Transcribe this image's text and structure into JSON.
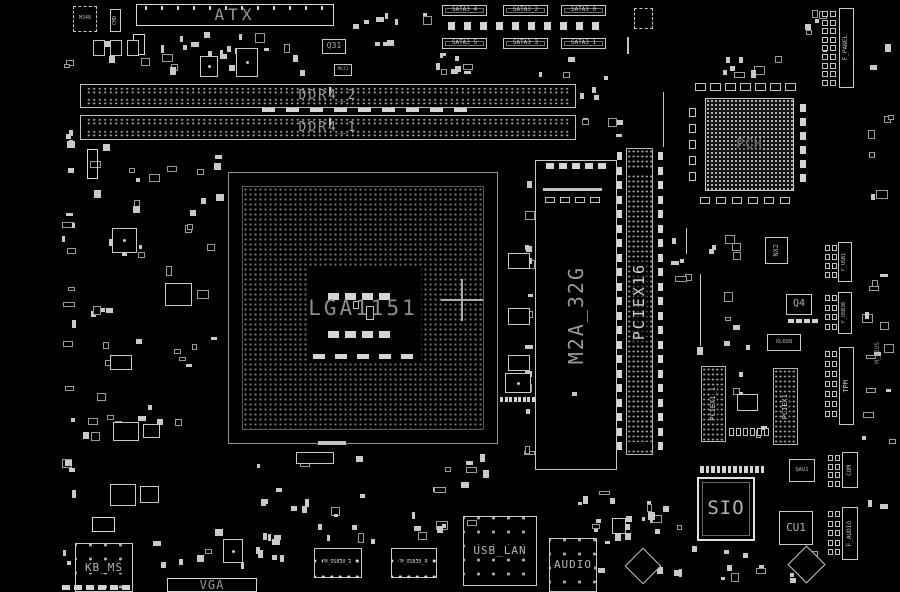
{
  "board": {
    "width": 900,
    "height": 592,
    "background": "#000000",
    "silkscreen": "#d0d0d0",
    "label_color": "#9a9a9a"
  },
  "parts": [
    {
      "t": "conn",
      "id": "atx-connector",
      "lab": "ATX",
      "x": 136,
      "y": 4,
      "w": 198,
      "h": 22,
      "fs": 16,
      "ls": 4,
      "ticks": true
    },
    {
      "t": "chip",
      "id": "chip-m348",
      "lab": "M348",
      "x": 73,
      "y": 6,
      "w": 24,
      "h": 26,
      "fs": 5,
      "dash": true
    },
    {
      "t": "vconn",
      "id": "conn-cmd",
      "lab": "CMD",
      "x": 110,
      "y": 9,
      "w": 11,
      "h": 23,
      "fs": 5
    },
    {
      "t": "conn",
      "id": "conn-small-1",
      "lab": "",
      "x": 133,
      "y": 34,
      "w": 12,
      "h": 21,
      "fs": 5
    },
    {
      "t": "chip",
      "id": "chip-q31",
      "lab": "Q31",
      "x": 322,
      "y": 39,
      "w": 24,
      "h": 15,
      "fs": 8
    },
    {
      "t": "chip",
      "id": "chip-mg71",
      "lab": "MG71",
      "x": 334,
      "y": 64,
      "w": 18,
      "h": 12,
      "fs": 4.5
    },
    {
      "t": "qfn",
      "id": "chip-u1",
      "x": 200,
      "y": 56,
      "w": 18,
      "h": 21
    },
    {
      "t": "qfn",
      "id": "chip-u2",
      "x": 236,
      "y": 48,
      "w": 22,
      "h": 29
    },
    {
      "t": "pads",
      "id": "cap-row",
      "x": 93,
      "y": 40,
      "cols": 3,
      "rows": 1,
      "dx": 17,
      "dy": 0,
      "pw": 12,
      "ph": 16,
      "hollow": true
    },
    {
      "t": "sconn",
      "id": "conn-sata3-4",
      "lab": "SATA3_4",
      "x": 442,
      "y": 5,
      "w": 45,
      "h": 11,
      "fs": 6
    },
    {
      "t": "sconn",
      "id": "conn-sata3-2",
      "lab": "SATA3_2",
      "x": 503,
      "y": 5,
      "w": 45,
      "h": 11,
      "fs": 6
    },
    {
      "t": "sconn",
      "id": "conn-sata3-0",
      "lab": "SATA3_0",
      "x": 561,
      "y": 5,
      "w": 45,
      "h": 11,
      "fs": 6
    },
    {
      "t": "sconn",
      "id": "conn-sata3-5",
      "lab": "SATA3_5",
      "x": 442,
      "y": 38,
      "w": 45,
      "h": 11,
      "fs": 6
    },
    {
      "t": "sconn",
      "id": "conn-sata3-3",
      "lab": "SATA3_3",
      "x": 503,
      "y": 38,
      "w": 45,
      "h": 11,
      "fs": 6
    },
    {
      "t": "sconn",
      "id": "conn-sata3-1",
      "lab": "SATA3_1",
      "x": 561,
      "y": 38,
      "w": 45,
      "h": 11,
      "fs": 6
    },
    {
      "t": "pads",
      "id": "sata-pad-row",
      "x": 448,
      "y": 22,
      "cols": 10,
      "rows": 1,
      "dx": 16,
      "dy": 0,
      "pw": 7,
      "ph": 8
    },
    {
      "t": "chip",
      "id": "chip-u8",
      "lab": "",
      "x": 634,
      "y": 8,
      "w": 19,
      "h": 21,
      "dash": true
    },
    {
      "t": "ln",
      "id": "silk-line-1",
      "x": 627,
      "y": 37,
      "w": 2,
      "h": 17
    },
    {
      "t": "dimm",
      "id": "slot-ddr4-2",
      "lab": "DDR4_2",
      "x": 80,
      "y": 84,
      "w": 496,
      "h": 24,
      "fs": 13
    },
    {
      "t": "dimm",
      "id": "slot-ddr4-1",
      "lab": "DDR4_1",
      "x": 80,
      "y": 115,
      "w": 496,
      "h": 25,
      "fs": 13
    },
    {
      "t": "pads",
      "id": "dimm-mid-pads",
      "x": 262,
      "y": 108,
      "cols": 9,
      "rows": 1,
      "dx": 24,
      "dy": 0,
      "pw": 13,
      "ph": 4
    },
    {
      "t": "cpu",
      "id": "socket-lga1151",
      "lab": "LGA1151",
      "x": 228,
      "y": 172,
      "w": 270,
      "h": 272,
      "fs": 21,
      "ko": [
        78,
        94,
        114,
        94
      ]
    },
    {
      "t": "cross",
      "id": "fiducial-cross",
      "x": 462,
      "y": 300,
      "s": 21
    },
    {
      "t": "m2",
      "id": "slot-m2a-32g",
      "lab": "M2A_32G",
      "x": 535,
      "y": 160,
      "w": 82,
      "h": 310,
      "fs": 20
    },
    {
      "t": "ln",
      "id": "m2-connector-bar",
      "x": 543,
      "y": 188,
      "w": 59,
      "h": 3
    },
    {
      "t": "pads",
      "id": "m2-pads-1",
      "x": 545,
      "y": 197,
      "cols": 4,
      "rows": 1,
      "dx": 15,
      "dy": 0,
      "pw": 10,
      "ph": 6,
      "hollow": true
    },
    {
      "t": "pads",
      "id": "m2-pads-2",
      "x": 546,
      "y": 163,
      "cols": 5,
      "rows": 1,
      "dx": 13,
      "dy": 0,
      "pw": 8,
      "ph": 6
    },
    {
      "t": "ln",
      "id": "m2-screw-pad",
      "x": 572,
      "y": 392,
      "w": 5,
      "h": 4
    },
    {
      "t": "px16",
      "id": "slot-pciex16",
      "lab": "PCIEX16",
      "x": 626,
      "y": 148,
      "w": 27,
      "h": 307,
      "fs": 15,
      "gaps": [
        20,
        293
      ]
    },
    {
      "t": "pads",
      "id": "px16-pads-left",
      "x": 617,
      "y": 152,
      "cols": 1,
      "rows": 21,
      "dx": 0,
      "dy": 14.5,
      "pw": 5,
      "ph": 8
    },
    {
      "t": "pads",
      "id": "px16-pads-right",
      "x": 658,
      "y": 152,
      "cols": 1,
      "rows": 21,
      "dx": 0,
      "dy": 14.5,
      "pw": 5,
      "ph": 8
    },
    {
      "t": "bga",
      "id": "chip-pch",
      "lab": "PCH",
      "x": 705,
      "y": 98,
      "w": 89,
      "h": 93,
      "fs": 13
    },
    {
      "t": "pads",
      "id": "pch-pads-top",
      "x": 695,
      "y": 83,
      "cols": 7,
      "rows": 1,
      "dx": 15,
      "dy": 0,
      "pw": 11,
      "ph": 8,
      "hollow": true
    },
    {
      "t": "pads",
      "id": "pch-pads-bottom",
      "x": 700,
      "y": 197,
      "cols": 6,
      "rows": 1,
      "dx": 16,
      "dy": 0,
      "pw": 10,
      "ph": 7,
      "hollow": true
    },
    {
      "t": "pads",
      "id": "pch-pads-left",
      "x": 689,
      "y": 108,
      "cols": 1,
      "rows": 5,
      "dx": 0,
      "dy": 16,
      "pw": 7,
      "ph": 9,
      "hollow": true
    },
    {
      "t": "pads",
      "id": "pch-pads-right",
      "x": 800,
      "y": 104,
      "cols": 1,
      "rows": 6,
      "dx": 0,
      "dy": 14,
      "pw": 6,
      "ph": 8
    },
    {
      "t": "vconn",
      "id": "conn-f-panel",
      "lab": "F_PANEL",
      "x": 839,
      "y": 8,
      "w": 15,
      "h": 80,
      "fs": 6
    },
    {
      "t": "pads",
      "id": "f-panel-pins",
      "x": 822,
      "y": 11,
      "cols": 2,
      "rows": 9,
      "dx": 8,
      "dy": 8.6,
      "pw": 6,
      "ph": 6,
      "hollow": true
    },
    {
      "t": "vconn",
      "id": "conn-f-usb1",
      "lab": "F_USB1",
      "x": 838,
      "y": 242,
      "w": 14,
      "h": 40,
      "fs": 5
    },
    {
      "t": "pads",
      "id": "f-usb1-pins",
      "x": 825,
      "y": 245,
      "cols": 2,
      "rows": 4,
      "dx": 7,
      "dy": 9,
      "pw": 5,
      "ph": 6,
      "hollow": true
    },
    {
      "t": "vconn",
      "id": "conn-f-usb30",
      "lab": "F_USB30",
      "x": 838,
      "y": 292,
      "w": 14,
      "h": 42,
      "fs": 5
    },
    {
      "t": "pads",
      "id": "f-usb30-pins",
      "x": 825,
      "y": 295,
      "cols": 2,
      "rows": 4,
      "dx": 7,
      "dy": 9.5,
      "pw": 5,
      "ph": 6,
      "hollow": true
    },
    {
      "t": "vconn",
      "id": "conn-tpm",
      "lab": "TPM",
      "x": 839,
      "y": 347,
      "w": 15,
      "h": 78,
      "fs": 7
    },
    {
      "t": "pads",
      "id": "tpm-pins",
      "x": 825,
      "y": 351,
      "cols": 2,
      "rows": 7,
      "dx": 7,
      "dy": 10,
      "pw": 5,
      "ph": 6,
      "hollow": true
    },
    {
      "t": "vconn",
      "id": "conn-com",
      "lab": "COM",
      "x": 842,
      "y": 452,
      "w": 16,
      "h": 36,
      "fs": 6
    },
    {
      "t": "pads",
      "id": "com-pins",
      "x": 828,
      "y": 455,
      "cols": 2,
      "rows": 4,
      "dx": 7,
      "dy": 8.5,
      "pw": 5,
      "ph": 6,
      "hollow": true
    },
    {
      "t": "vconn",
      "id": "conn-f-audio",
      "lab": "F_AUDIO",
      "x": 842,
      "y": 507,
      "w": 16,
      "h": 53,
      "fs": 6
    },
    {
      "t": "pads",
      "id": "f-audio-pins",
      "x": 828,
      "y": 511,
      "cols": 2,
      "rows": 5,
      "dx": 7,
      "dy": 9.5,
      "pw": 5,
      "ph": 6,
      "hollow": true
    },
    {
      "t": "vlabel",
      "id": "label-m-bios",
      "lab": "M_BIOS",
      "x": 872,
      "y": 330,
      "w": 12,
      "h": 46,
      "fs": 6
    },
    {
      "t": "vslot",
      "id": "slot-pciex1-1",
      "lab": "PCIEX1_1",
      "x": 701,
      "y": 366,
      "w": 25,
      "h": 76,
      "fs": 7
    },
    {
      "t": "vslot",
      "id": "slot-pciex1",
      "lab": "PCIEX1",
      "x": 773,
      "y": 368,
      "w": 25,
      "h": 77,
      "fs": 7
    },
    {
      "t": "chip",
      "id": "chip-nx2",
      "lab": "NX2",
      "x": 765,
      "y": 237,
      "w": 23,
      "h": 27,
      "fs": 7,
      "vlab": true
    },
    {
      "t": "chip",
      "id": "chip-q4",
      "lab": "Q4",
      "x": 786,
      "y": 294,
      "w": 26,
      "h": 21,
      "fs": 10
    },
    {
      "t": "pads",
      "id": "q4-pads",
      "x": 788,
      "y": 319,
      "cols": 4,
      "rows": 1,
      "dx": 8,
      "dy": 0,
      "pw": 6,
      "ph": 4
    },
    {
      "t": "chip",
      "id": "chip-bios",
      "lab": "XL608",
      "x": 767,
      "y": 334,
      "w": 34,
      "h": 17,
      "fs": 5.5
    },
    {
      "t": "chip",
      "id": "chip-u9",
      "lab": "",
      "x": 737,
      "y": 394,
      "w": 21,
      "h": 17
    },
    {
      "t": "pads",
      "id": "hdr-pads-mid",
      "x": 729,
      "y": 428,
      "cols": 6,
      "rows": 1,
      "dx": 7,
      "dy": 0,
      "pw": 5,
      "ph": 8,
      "hollow": true
    },
    {
      "t": "chip2",
      "id": "chip-sio",
      "lab": "SIO",
      "x": 697,
      "y": 477,
      "w": 58,
      "h": 64,
      "fs": 19
    },
    {
      "t": "pads",
      "id": "sio-pads-top",
      "x": 700,
      "y": 466,
      "cols": 12,
      "rows": 1,
      "dx": 5.5,
      "dy": 0,
      "pw": 3.5,
      "ph": 7
    },
    {
      "t": "chip",
      "id": "chip-qau1",
      "lab": "QAU1",
      "x": 789,
      "y": 459,
      "w": 26,
      "h": 23,
      "fs": 5.5
    },
    {
      "t": "chip",
      "id": "chip-cu1",
      "lab": "CU1",
      "x": 779,
      "y": 511,
      "w": 34,
      "h": 34,
      "fs": 11
    },
    {
      "t": "diam",
      "id": "chip-diamond-1",
      "x": 630,
      "y": 553,
      "s": 26
    },
    {
      "t": "diam",
      "id": "chip-diamond-2",
      "x": 793,
      "y": 551,
      "s": 27
    },
    {
      "t": "bigconn",
      "id": "conn-kb-ms",
      "lab": "KB_MS",
      "x": 75,
      "y": 543,
      "w": 58,
      "h": 49,
      "fs": 11
    },
    {
      "t": "conn",
      "id": "conn-vga",
      "lab": "VGA",
      "x": 167,
      "y": 578,
      "w": 90,
      "h": 14,
      "fs": 12,
      "ls": 1
    },
    {
      "t": "bigconn",
      "id": "conn-usb-lan",
      "lab": "USB_LAN",
      "x": 463,
      "y": 516,
      "w": 74,
      "h": 70,
      "fs": 11
    },
    {
      "t": "bigconn",
      "id": "conn-audio",
      "lab": "AUDIO",
      "x": 549,
      "y": 538,
      "w": 48,
      "h": 54,
      "fs": 11
    },
    {
      "t": "hdr",
      "id": "header-m-usb30-2",
      "lab": "M_USB30_2",
      "x": 314,
      "y": 548,
      "w": 48,
      "h": 30,
      "fs": 5
    },
    {
      "t": "hdr",
      "id": "header-m-usb30-4",
      "lab": "M_USB30_4",
      "x": 391,
      "y": 548,
      "w": 46,
      "h": 30,
      "fs": 5
    },
    {
      "t": "qfn",
      "id": "chip-vga-ctrl",
      "x": 223,
      "y": 539,
      "w": 20,
      "h": 24
    },
    {
      "t": "chip",
      "id": "chip-u10",
      "lab": "",
      "x": 612,
      "y": 518,
      "w": 14,
      "h": 16
    },
    {
      "t": "ln",
      "id": "silk-bar-1",
      "x": 318,
      "y": 441,
      "w": 28,
      "h": 4
    },
    {
      "t": "chip",
      "id": "chip-u11",
      "lab": "",
      "x": 296,
      "y": 452,
      "w": 38,
      "h": 12
    },
    {
      "t": "qfn",
      "id": "chip-u12",
      "x": 112,
      "y": 228,
      "w": 25,
      "h": 25
    },
    {
      "t": "chip",
      "id": "chip-u13",
      "lab": "",
      "x": 165,
      "y": 283,
      "w": 27,
      "h": 23
    },
    {
      "t": "chip",
      "id": "chip-u14",
      "lab": "",
      "x": 110,
      "y": 355,
      "w": 22,
      "h": 15
    },
    {
      "t": "chip",
      "id": "chip-u15",
      "lab": "",
      "x": 113,
      "y": 422,
      "w": 26,
      "h": 19
    },
    {
      "t": "chip",
      "id": "chip-u16",
      "lab": "",
      "x": 143,
      "y": 424,
      "w": 17,
      "h": 14
    },
    {
      "t": "chip",
      "id": "chip-u17",
      "lab": "",
      "x": 110,
      "y": 484,
      "w": 26,
      "h": 22
    },
    {
      "t": "chip",
      "id": "chip-u18",
      "lab": "",
      "x": 140,
      "y": 486,
      "w": 19,
      "h": 17
    },
    {
      "t": "conn",
      "id": "conn-small-2",
      "lab": "",
      "x": 87,
      "y": 149,
      "w": 11,
      "h": 30
    },
    {
      "t": "chip",
      "id": "chip-u19",
      "lab": "",
      "x": 508,
      "y": 253,
      "w": 22,
      "h": 16
    },
    {
      "t": "chip",
      "id": "chip-u20",
      "lab": "",
      "x": 508,
      "y": 308,
      "w": 22,
      "h": 17
    },
    {
      "t": "chip",
      "id": "chip-u21",
      "lab": "",
      "x": 508,
      "y": 355,
      "w": 22,
      "h": 16
    },
    {
      "t": "qfn",
      "id": "chip-u22",
      "x": 505,
      "y": 373,
      "w": 26,
      "h": 20
    },
    {
      "t": "pads",
      "id": "u22-pads",
      "x": 500,
      "y": 397,
      "cols": 8,
      "rows": 1,
      "dx": 4.5,
      "dy": 0,
      "pw": 3,
      "ph": 5
    },
    {
      "t": "conn",
      "id": "conn-small-3",
      "lab": "",
      "x": 92,
      "y": 517,
      "w": 23,
      "h": 15
    },
    {
      "t": "ln",
      "id": "silk-line-2",
      "x": 663,
      "y": 92,
      "w": 1,
      "h": 55
    },
    {
      "t": "ln",
      "id": "silk-line-3",
      "x": 686,
      "y": 228,
      "w": 1,
      "h": 26
    },
    {
      "t": "ln",
      "id": "silk-line-4",
      "x": 700,
      "y": 274,
      "w": 1,
      "h": 72
    },
    {
      "t": "pads",
      "id": "bottom-edge-pads",
      "x": 62,
      "y": 585,
      "cols": 6,
      "rows": 1,
      "dx": 12,
      "dy": 0,
      "pw": 8,
      "ph": 5
    }
  ],
  "clusters": [
    {
      "x": 88,
      "y": 28,
      "w": 245,
      "h": 50,
      "n": 26,
      "s": 11
    },
    {
      "x": 340,
      "y": 6,
      "w": 92,
      "h": 52,
      "n": 10,
      "s": 12
    },
    {
      "x": 432,
      "y": 52,
      "w": 195,
      "h": 28,
      "n": 14,
      "s": 13
    },
    {
      "x": 580,
      "y": 84,
      "w": 45,
      "h": 60,
      "n": 8,
      "s": 14
    },
    {
      "x": 62,
      "y": 8,
      "w": 14,
      "h": 570,
      "n": 24,
      "s": 15
    },
    {
      "x": 80,
      "y": 140,
      "w": 145,
      "h": 185,
      "n": 30,
      "s": 16
    },
    {
      "x": 80,
      "y": 330,
      "w": 145,
      "h": 140,
      "n": 18,
      "s": 17
    },
    {
      "x": 240,
      "y": 446,
      "w": 260,
      "h": 80,
      "n": 22,
      "s": 18
    },
    {
      "x": 560,
      "y": 455,
      "w": 130,
      "h": 80,
      "n": 14,
      "s": 19
    },
    {
      "x": 658,
      "y": 215,
      "w": 100,
      "h": 145,
      "n": 16,
      "s": 20
    },
    {
      "x": 690,
      "y": 55,
      "w": 110,
      "h": 28,
      "n": 8,
      "s": 21
    },
    {
      "x": 800,
      "y": 10,
      "w": 34,
      "h": 60,
      "n": 6,
      "s": 22
    },
    {
      "x": 862,
      "y": 40,
      "w": 34,
      "h": 480,
      "n": 24,
      "s": 23
    },
    {
      "x": 140,
      "y": 512,
      "w": 155,
      "h": 60,
      "n": 16,
      "s": 24
    },
    {
      "x": 300,
      "y": 520,
      "w": 160,
      "h": 26,
      "n": 10,
      "s": 25
    },
    {
      "x": 598,
      "y": 500,
      "w": 100,
      "h": 88,
      "n": 12,
      "s": 26
    },
    {
      "x": 700,
      "y": 545,
      "w": 130,
      "h": 42,
      "n": 10,
      "s": 27
    },
    {
      "x": 524,
      "y": 165,
      "w": 9,
      "h": 300,
      "n": 14,
      "s": 28
    },
    {
      "x": 730,
      "y": 370,
      "w": 40,
      "h": 70,
      "n": 6,
      "s": 29
    }
  ]
}
